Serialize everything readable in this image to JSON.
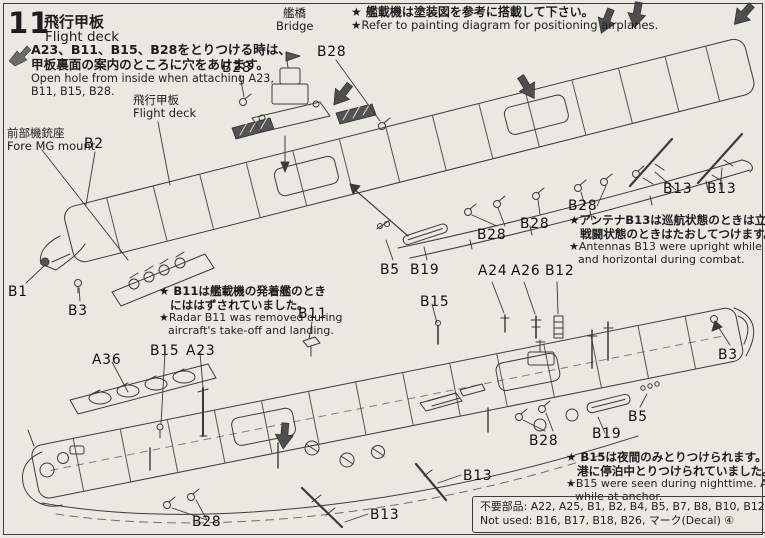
{
  "page": {
    "step_number": "11",
    "title_jp": "飛行甲板",
    "title_en": "Flight deck",
    "paper_color": "#eae8e1",
    "ink_color": "#3a3a3a",
    "arrow_color": "#4e4e4e"
  },
  "header_note": {
    "jp_line1": "A23、B11、B15、B28をとりつける時は、",
    "jp_line2": "甲板裏面の案内のところに穴をあけます。",
    "en_line1": "Open hole from inside when attaching A23,",
    "en_line2": "B11, B15, B28."
  },
  "top_note": {
    "jp": "★ 艦載機は塗装図を参考に搭載して下さい。",
    "en": "★Refer to painting diagram for positioning airplanes."
  },
  "callouts": {
    "bridge_jp": "艦橋",
    "bridge_en": "Bridge",
    "flight_deck_jp": "飛行甲板",
    "flight_deck_en": "Flight deck",
    "fore_mg_jp": "前部機銃座",
    "fore_mg_en": "Fore MG mount"
  },
  "notes": {
    "antenna": {
      "jp1": "★アンテナB13は巡航状態のときは立て、",
      "jp2": "戦闘状態のときはたおしてつけます。",
      "en1": "★Antennas B13 were upright while cruising",
      "en2": "and horizontal during combat."
    },
    "radar": {
      "jp1": "★ B11は艦載機の発着艦のとき",
      "jp2": "にははずされていました。",
      "en1": "★Radar B11 was removed during",
      "en2": "aircraft's take-off and landing."
    },
    "night": {
      "jp1": "★ B15は夜間のみとりつけられます。又 A23は",
      "jp2": "港に停泊中とりつけられていました。",
      "en1": "★B15 were seen during nighttime. A23 was used",
      "en2": "while at anchor."
    }
  },
  "not_used_box": {
    "line1": "不要部品: A22, A25, B1, B2, B4, B5, B7, B8, B10, B12, B14, B15",
    "line2": "Not used: B16, B17, B18, B26, マーク(Decal) ④"
  },
  "part_labels": [
    {
      "text": "B28",
      "x": 222,
      "y": 60
    },
    {
      "text": "B28",
      "x": 317,
      "y": 44
    },
    {
      "text": "B2",
      "x": 84,
      "y": 136
    },
    {
      "text": "B1",
      "x": 8,
      "y": 284
    },
    {
      "text": "B3",
      "x": 68,
      "y": 303
    },
    {
      "text": "B5",
      "x": 380,
      "y": 262
    },
    {
      "text": "B19",
      "x": 410,
      "y": 262
    },
    {
      "text": "B28",
      "x": 477,
      "y": 227
    },
    {
      "text": "B28",
      "x": 520,
      "y": 216
    },
    {
      "text": "B28",
      "x": 568,
      "y": 198
    },
    {
      "text": "B13",
      "x": 663,
      "y": 181
    },
    {
      "text": "B13",
      "x": 707,
      "y": 181
    },
    {
      "text": "B11",
      "x": 298,
      "y": 306
    },
    {
      "text": "B15",
      "x": 420,
      "y": 294
    },
    {
      "text": "A24",
      "x": 478,
      "y": 263
    },
    {
      "text": "A26",
      "x": 511,
      "y": 263
    },
    {
      "text": "B12",
      "x": 545,
      "y": 263
    },
    {
      "text": "A36",
      "x": 92,
      "y": 352
    },
    {
      "text": "B15",
      "x": 150,
      "y": 343
    },
    {
      "text": "A23",
      "x": 186,
      "y": 343
    },
    {
      "text": "B28",
      "x": 192,
      "y": 514
    },
    {
      "text": "B13",
      "x": 370,
      "y": 507
    },
    {
      "text": "B13",
      "x": 463,
      "y": 468
    },
    {
      "text": "B28",
      "x": 529,
      "y": 433
    },
    {
      "text": "B19",
      "x": 592,
      "y": 426
    },
    {
      "text": "B5",
      "x": 628,
      "y": 409
    },
    {
      "text": "B3",
      "x": 718,
      "y": 347
    }
  ],
  "arrows": [
    {
      "x": 340,
      "y": 97,
      "r": 38
    },
    {
      "x": 529,
      "y": 90,
      "r": -32
    },
    {
      "x": 605,
      "y": 24,
      "r": 22
    },
    {
      "x": 636,
      "y": 18,
      "r": 10
    },
    {
      "x": 741,
      "y": 17,
      "r": 42
    },
    {
      "x": 284,
      "y": 439,
      "r": 5
    }
  ]
}
